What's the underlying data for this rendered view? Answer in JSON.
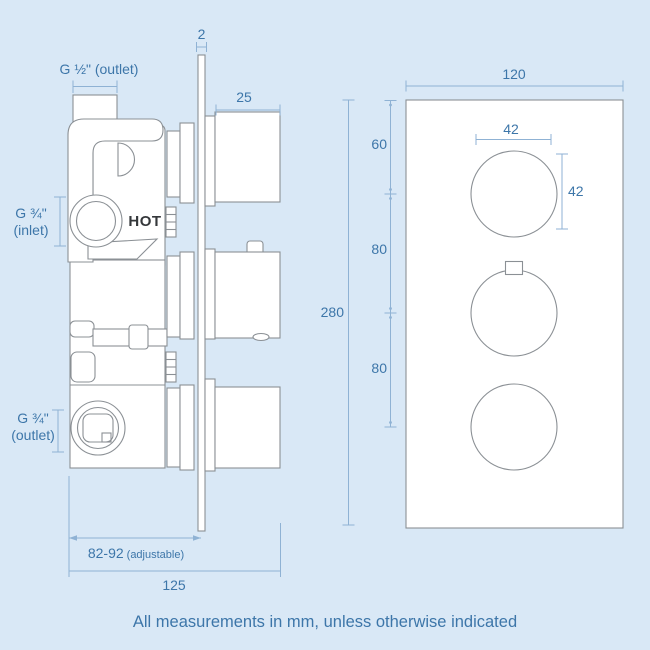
{
  "colors": {
    "background": "#d9e8f6",
    "drawing_outline": "#8b9095",
    "dimension_line": "#8fb2d4",
    "dimension_text": "#3d76a9",
    "hot_marking_text": "#35383b",
    "surface": "#ffffff"
  },
  "side_view": {
    "labels": {
      "top_port": "G ½\" (outlet)",
      "plate_thickness": "2",
      "knob_depth": "25",
      "inlet_size": "G ¾\"",
      "inlet_type": "(inlet)",
      "hot_marking": "HOT",
      "outlet_size": "G ¾\"",
      "outlet_type": "(outlet)",
      "depth_range": "82-92",
      "depth_range_note": "(adjustable)",
      "total_depth": "125"
    }
  },
  "front_view": {
    "labels": {
      "plate_width": "120",
      "knob_width": "42",
      "knob_height": "42",
      "top_to_first_knob": "60",
      "first_to_second_knob": "80",
      "second_to_third_knob": "80",
      "plate_height": "280"
    }
  },
  "footer": {
    "note": "All measurements in mm, unless otherwise indicated"
  }
}
